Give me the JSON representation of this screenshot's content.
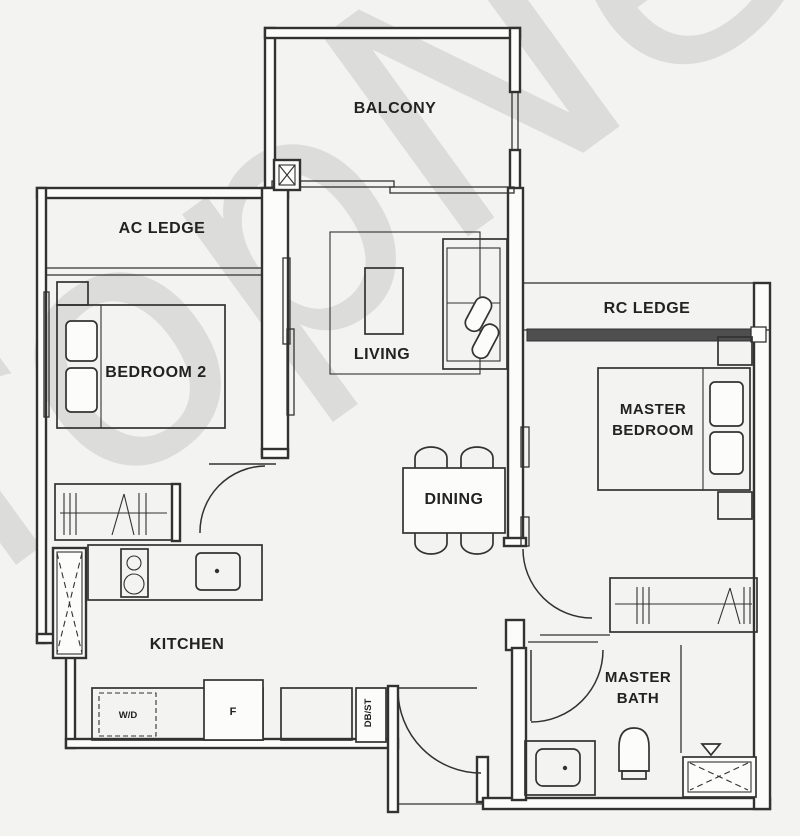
{
  "watermark": {
    "text": "PropNex"
  },
  "colors": {
    "watermark": "#bdbdbd",
    "wall": "#323232",
    "window_band": "#4f4f4f",
    "background": "#f3f3f1"
  },
  "labels": {
    "balcony": "BALCONY",
    "ac_ledge": "AC LEDGE",
    "bedroom2": "BEDROOM 2",
    "living": "LIVING",
    "rc_ledge": "RC LEDGE",
    "master_bedroom": {
      "line1": "MASTER",
      "line2": "BEDROOM"
    },
    "dining": "DINING",
    "kitchen": "KITCHEN",
    "master_bath": {
      "line1": "MASTER",
      "line2": "BATH"
    },
    "washer_dryer": "W/D",
    "fridge": "F",
    "db_st": "DB/ST"
  }
}
